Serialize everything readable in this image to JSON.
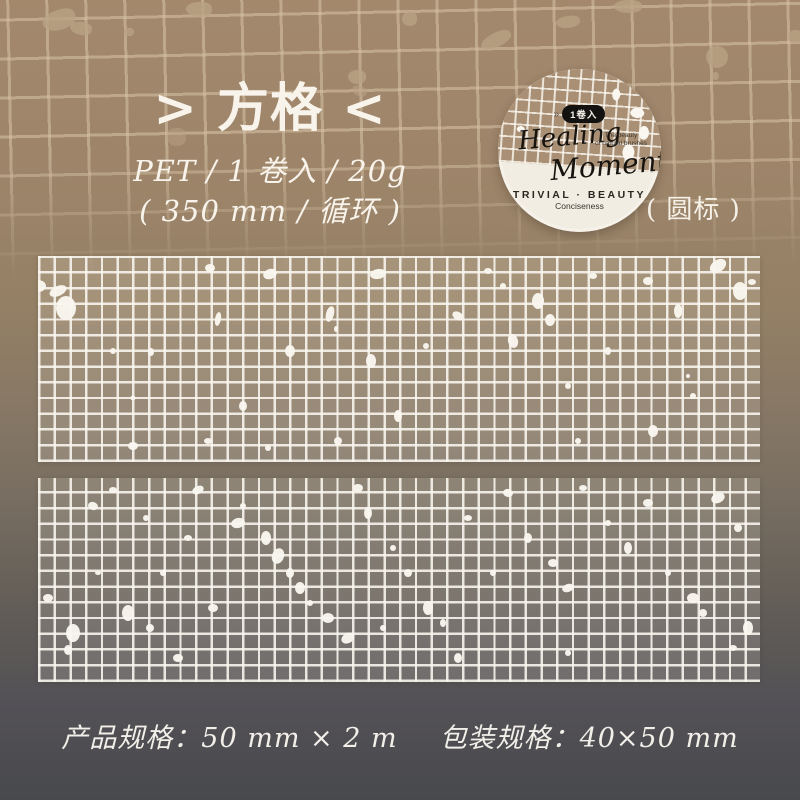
{
  "colors": {
    "background_top": "#a3886c",
    "background_bottom": "#48494d",
    "tape_grid_line": "#faf7f0",
    "label_cream": "#f1ede3",
    "label_tan": "#a98f74",
    "badge_background": "#141210",
    "text_light": "#f8f4ec"
  },
  "header": {
    "title": "> 方格 <",
    "spec_line1": "PET / 1 卷入 / 20g",
    "spec_line2": "( 350 mm / 循环 )"
  },
  "roll_label": {
    "badge_prefix": "»",
    "badge_text": "1卷入",
    "script_word1": "Healing",
    "script_word2": "Moment",
    "tagline_line1": "The beauty",
    "tagline_line2": "of natural brushes",
    "brand": "TRIVIAL · BEAUTY",
    "brand_sub": "Conciseness"
  },
  "roll_caption": "( 圆标 )",
  "footer": {
    "product_spec": "产品规格：50 mm × 2 m",
    "package_spec": "包装规格：40×50 mm"
  }
}
